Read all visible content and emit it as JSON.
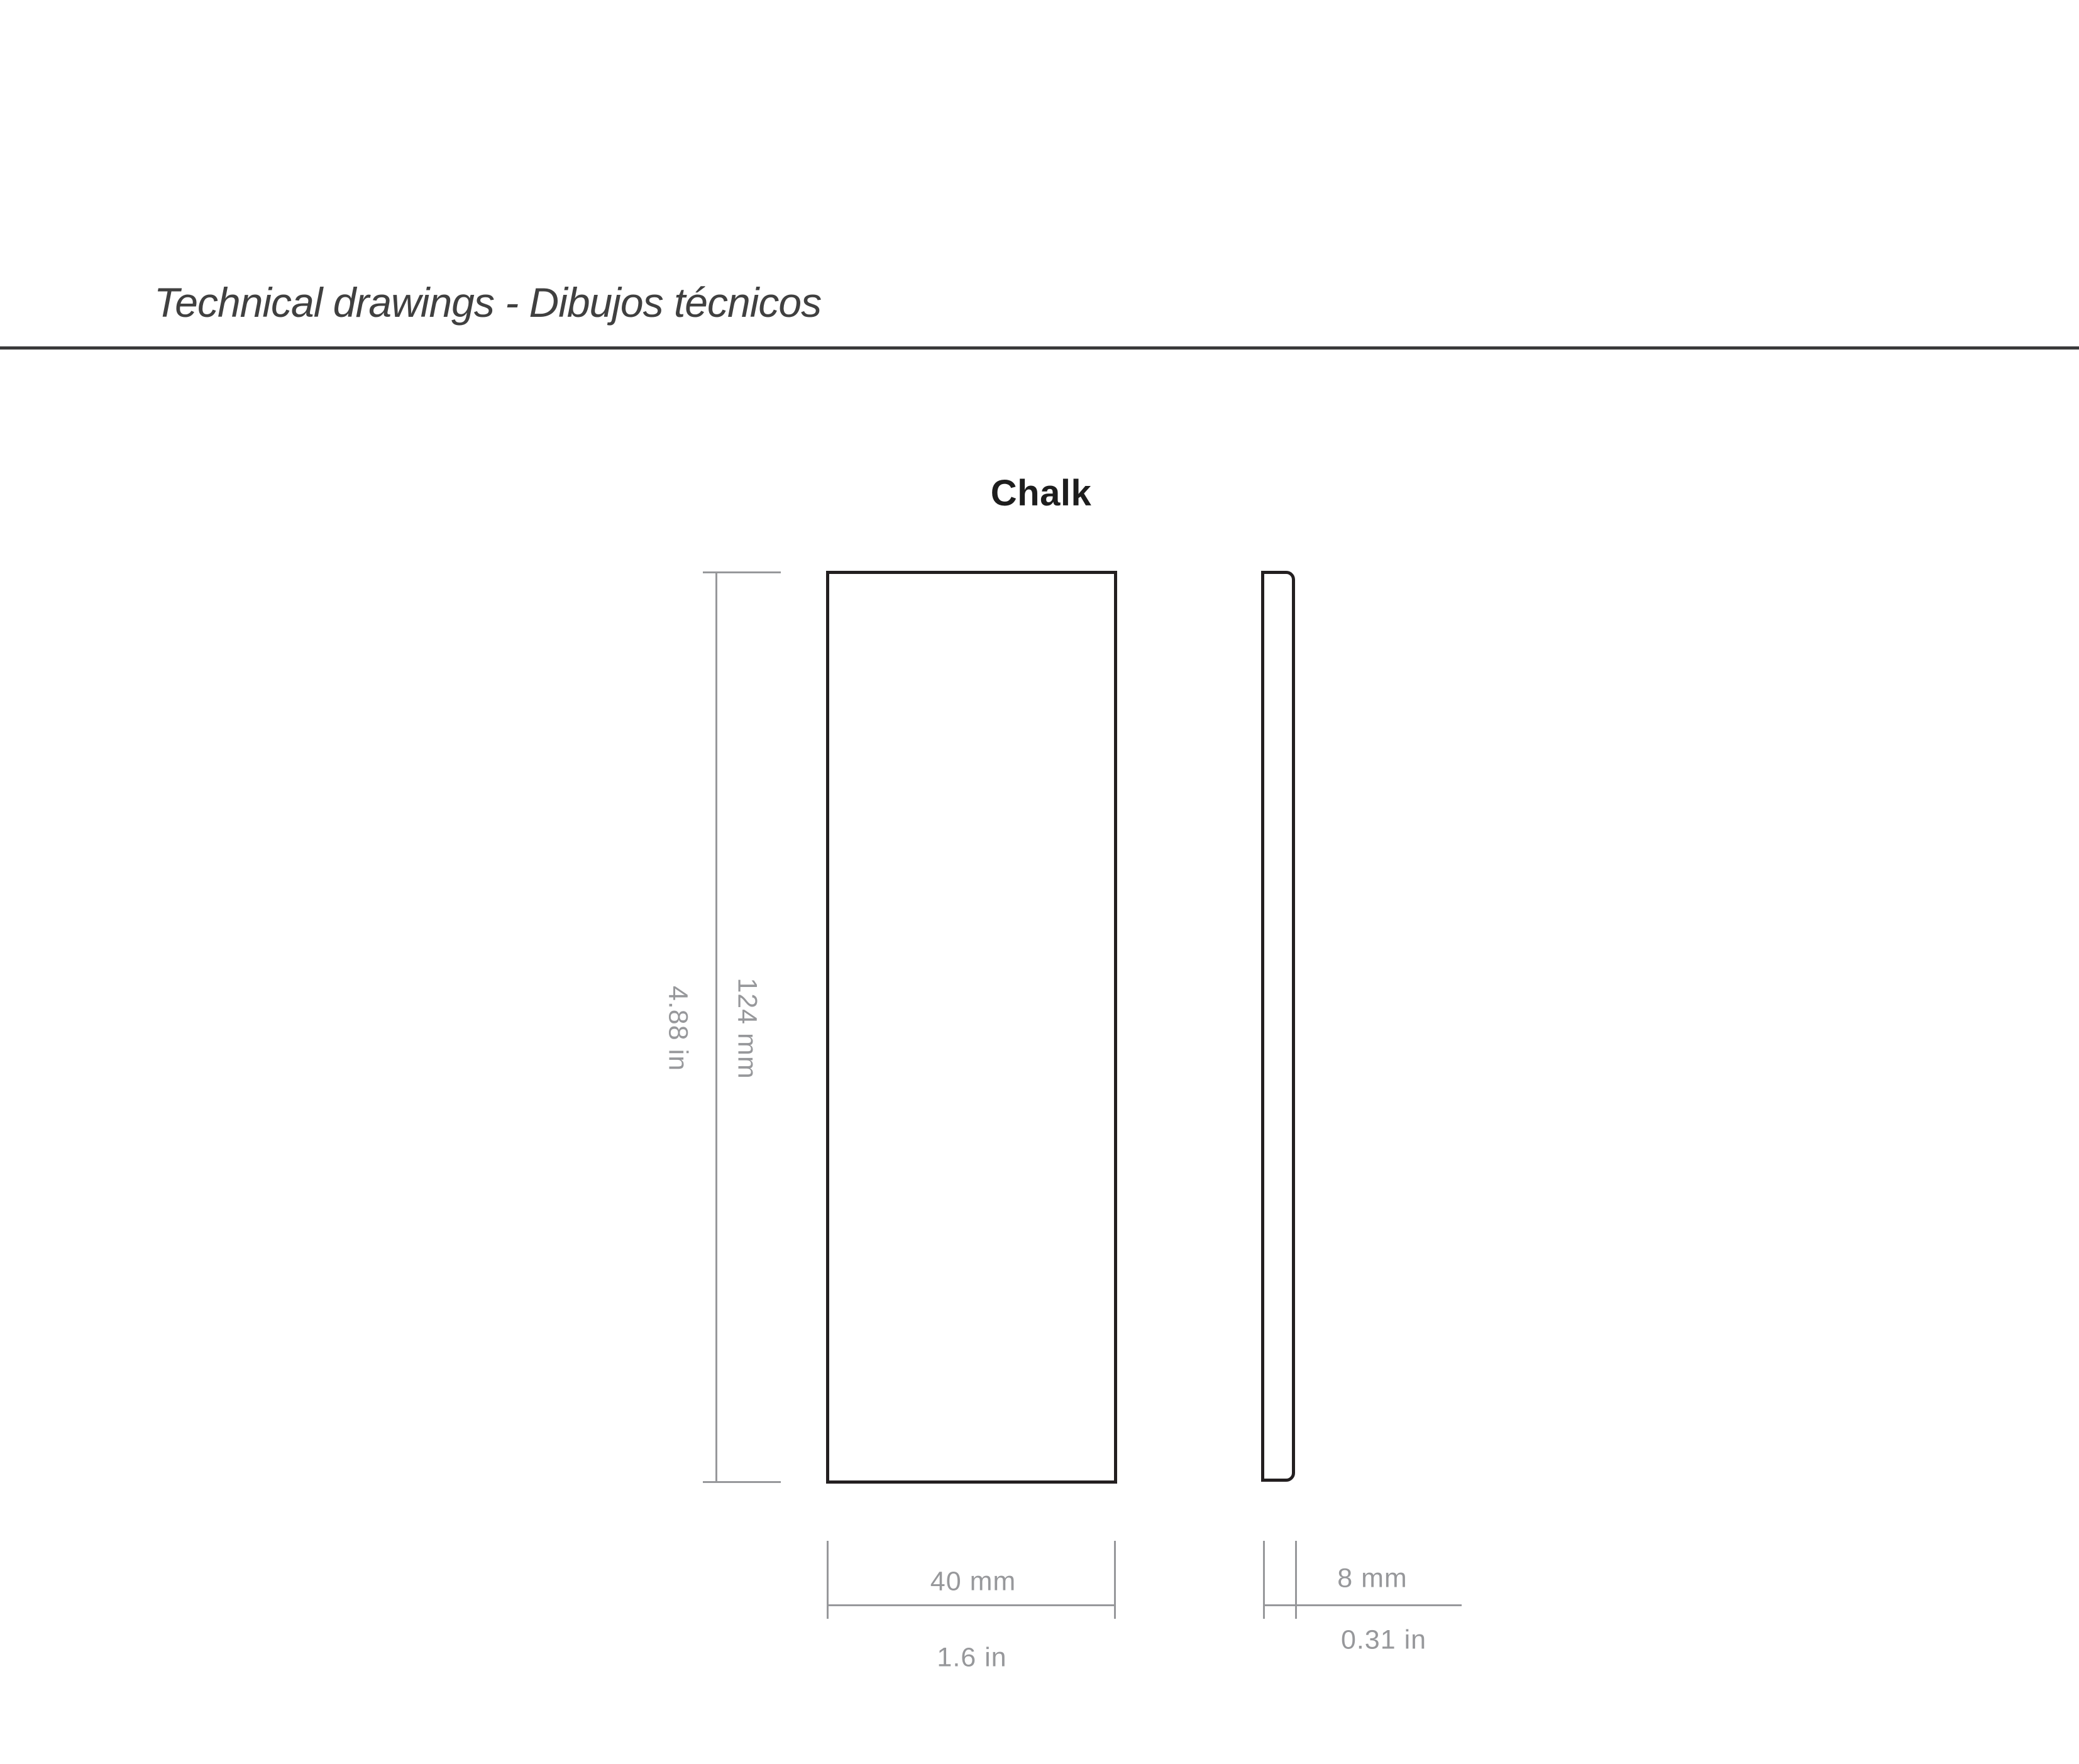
{
  "header": {
    "title": "Technical drawings - Dibujos técnicos"
  },
  "drawing": {
    "product_name": "Chalk",
    "views": {
      "front_view": "front-view-outline",
      "side_view": "side-view-outline"
    },
    "dimensions": {
      "height_mm": "124 mm",
      "height_in": "4.88 in",
      "width_mm": "40 mm",
      "width_in": "1.6 in",
      "thickness_mm": "8 mm",
      "thickness_in": "0.31 in"
    }
  },
  "colors": {
    "background": "#ffffff",
    "outline_black": "#231f20",
    "dimension_gray": "#97989b",
    "header_rule": "#3a3a3b",
    "title_text": "#404040",
    "product_name_text": "#1d1d1d"
  }
}
